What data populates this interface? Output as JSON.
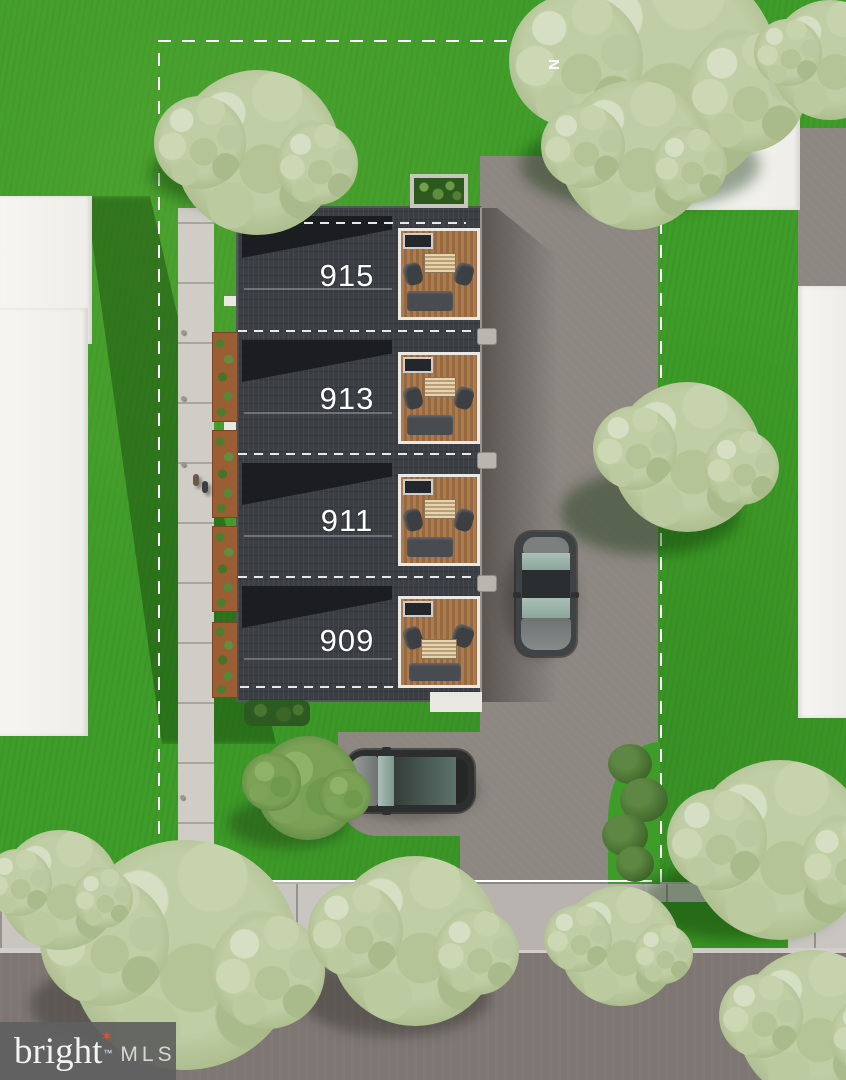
{
  "scene": {
    "type": "aerial-site-rendering",
    "units": [
      {
        "label": "915"
      },
      {
        "label": "913"
      },
      {
        "label": "911"
      },
      {
        "label": "909"
      }
    ],
    "north_indicator": "N",
    "watermark": {
      "brand": "bright",
      "trademark": "™",
      "suffix": "MLS"
    },
    "colors": {
      "grass": "#3e9c28",
      "roof": "#3b3e43",
      "driveway": "#8d8782",
      "sidewalk": "#c9c6c1",
      "street": "#7d7672",
      "deck_wood": "#ad7c4e",
      "tree_foliage": "#b6c698",
      "boundary_line": "#ffffff",
      "watermark_bg": "#606060",
      "watermark_accent": "#e4512b"
    }
  }
}
